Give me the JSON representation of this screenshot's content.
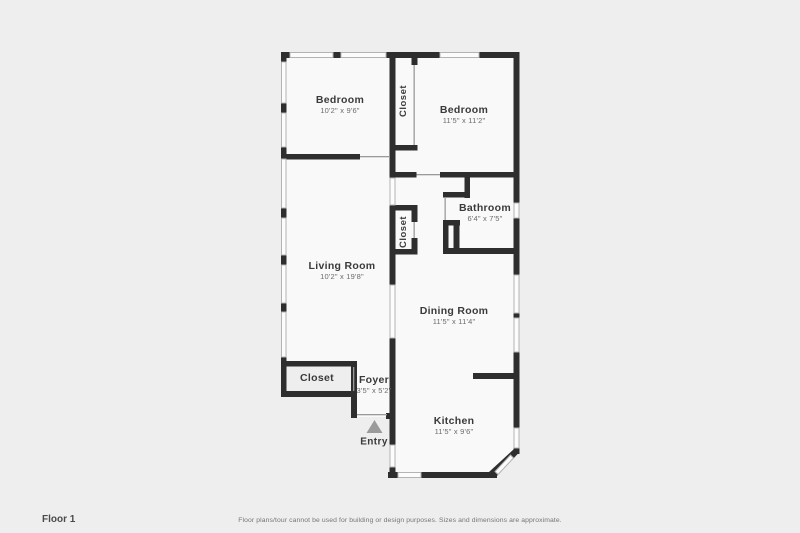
{
  "rooms": [
    {
      "id": "bedroom-left",
      "name": "Bedroom",
      "dims": "10'2\" x 9'6\""
    },
    {
      "id": "closet-top",
      "name": "Closet",
      "dims": ""
    },
    {
      "id": "bedroom-right",
      "name": "Bedroom",
      "dims": "11'5\" x 11'2\""
    },
    {
      "id": "bathroom",
      "name": "Bathroom",
      "dims": "6'4\" x 7'5\""
    },
    {
      "id": "living-room",
      "name": "Living Room",
      "dims": "10'2\" x 19'8\""
    },
    {
      "id": "closet-middle",
      "name": "Closet",
      "dims": ""
    },
    {
      "id": "dining-room",
      "name": "Dining Room",
      "dims": "11'5\" x 11'4\""
    },
    {
      "id": "closet-entry",
      "name": "Closet",
      "dims": ""
    },
    {
      "id": "foyer",
      "name": "Foyer",
      "dims": "3'5\" x 5'2\""
    },
    {
      "id": "kitchen",
      "name": "Kitchen",
      "dims": "11'5\" x 9'6\""
    }
  ],
  "entry": {
    "label": "Entry"
  },
  "footer": {
    "floor_label": "Floor 1",
    "disclaimer": "Floor plans/tour cannot be used for building or design purposes. Sizes and dimensions are approximate."
  },
  "colors": {
    "wall": "#2e2e2e",
    "floor": "#f9f9f9",
    "page_background": "#eeeeee",
    "entry_arrow": "#9a9a9a"
  }
}
